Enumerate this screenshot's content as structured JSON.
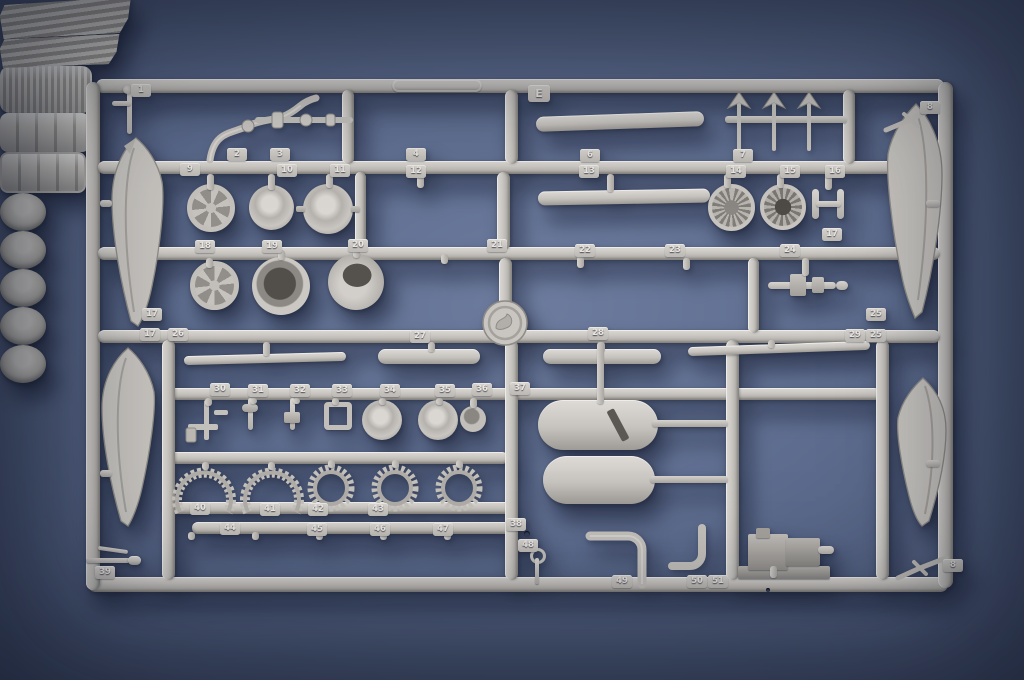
{
  "sprue": {
    "letter_tab": {
      "label": "E"
    },
    "colors": {
      "plastic": "#c9c6c1",
      "plastic_highlight": "#dcd9d4",
      "plastic_shadow": "#9e9b96",
      "background": "#5d6c8e",
      "background_edge": "#323c55"
    },
    "part_tabs": [
      {
        "n": "1",
        "x": 131,
        "y": 84
      },
      {
        "n": "2",
        "x": 227,
        "y": 148
      },
      {
        "n": "3",
        "x": 270,
        "y": 148
      },
      {
        "n": "4",
        "x": 406,
        "y": 148
      },
      {
        "n": "6",
        "x": 580,
        "y": 149
      },
      {
        "n": "7",
        "x": 733,
        "y": 149
      },
      {
        "n": "8",
        "x": 920,
        "y": 101
      },
      {
        "n": "9",
        "x": 180,
        "y": 163
      },
      {
        "n": "10",
        "x": 277,
        "y": 164
      },
      {
        "n": "11",
        "x": 330,
        "y": 164
      },
      {
        "n": "12",
        "x": 406,
        "y": 165
      },
      {
        "n": "13",
        "x": 579,
        "y": 165
      },
      {
        "n": "14",
        "x": 726,
        "y": 165
      },
      {
        "n": "15",
        "x": 780,
        "y": 165
      },
      {
        "n": "16",
        "x": 825,
        "y": 165
      },
      {
        "n": "17",
        "x": 822,
        "y": 228
      },
      {
        "n": "18",
        "x": 195,
        "y": 240
      },
      {
        "n": "19",
        "x": 262,
        "y": 240
      },
      {
        "n": "20",
        "x": 348,
        "y": 239
      },
      {
        "n": "21",
        "x": 487,
        "y": 239
      },
      {
        "n": "22",
        "x": 575,
        "y": 244
      },
      {
        "n": "23",
        "x": 665,
        "y": 244
      },
      {
        "n": "24",
        "x": 780,
        "y": 244
      },
      {
        "n": "17",
        "x": 142,
        "y": 308
      },
      {
        "n": "25",
        "x": 866,
        "y": 308
      },
      {
        "n": "17",
        "x": 140,
        "y": 328
      },
      {
        "n": "26",
        "x": 168,
        "y": 328
      },
      {
        "n": "25",
        "x": 866,
        "y": 329
      },
      {
        "n": "27",
        "x": 410,
        "y": 330
      },
      {
        "n": "28",
        "x": 588,
        "y": 327
      },
      {
        "n": "29",
        "x": 845,
        "y": 329
      },
      {
        "n": "30",
        "x": 210,
        "y": 383
      },
      {
        "n": "31",
        "x": 248,
        "y": 384
      },
      {
        "n": "32",
        "x": 290,
        "y": 384
      },
      {
        "n": "33",
        "x": 332,
        "y": 384
      },
      {
        "n": "34",
        "x": 380,
        "y": 384
      },
      {
        "n": "35",
        "x": 435,
        "y": 384
      },
      {
        "n": "36",
        "x": 472,
        "y": 383
      },
      {
        "n": "37",
        "x": 510,
        "y": 382
      },
      {
        "n": "38",
        "x": 506,
        "y": 518
      },
      {
        "n": "39",
        "x": 95,
        "y": 566
      },
      {
        "n": "40",
        "x": 190,
        "y": 502
      },
      {
        "n": "41",
        "x": 260,
        "y": 503
      },
      {
        "n": "42",
        "x": 308,
        "y": 503
      },
      {
        "n": "43",
        "x": 368,
        "y": 503
      },
      {
        "n": "44",
        "x": 220,
        "y": 522
      },
      {
        "n": "45",
        "x": 307,
        "y": 523
      },
      {
        "n": "46",
        "x": 370,
        "y": 523
      },
      {
        "n": "47",
        "x": 433,
        "y": 523
      },
      {
        "n": "48",
        "x": 518,
        "y": 539
      },
      {
        "n": "49",
        "x": 612,
        "y": 575
      },
      {
        "n": "50",
        "x": 687,
        "y": 575
      },
      {
        "n": "51",
        "x": 708,
        "y": 575
      },
      {
        "n": "8",
        "x": 943,
        "y": 559
      }
    ]
  }
}
